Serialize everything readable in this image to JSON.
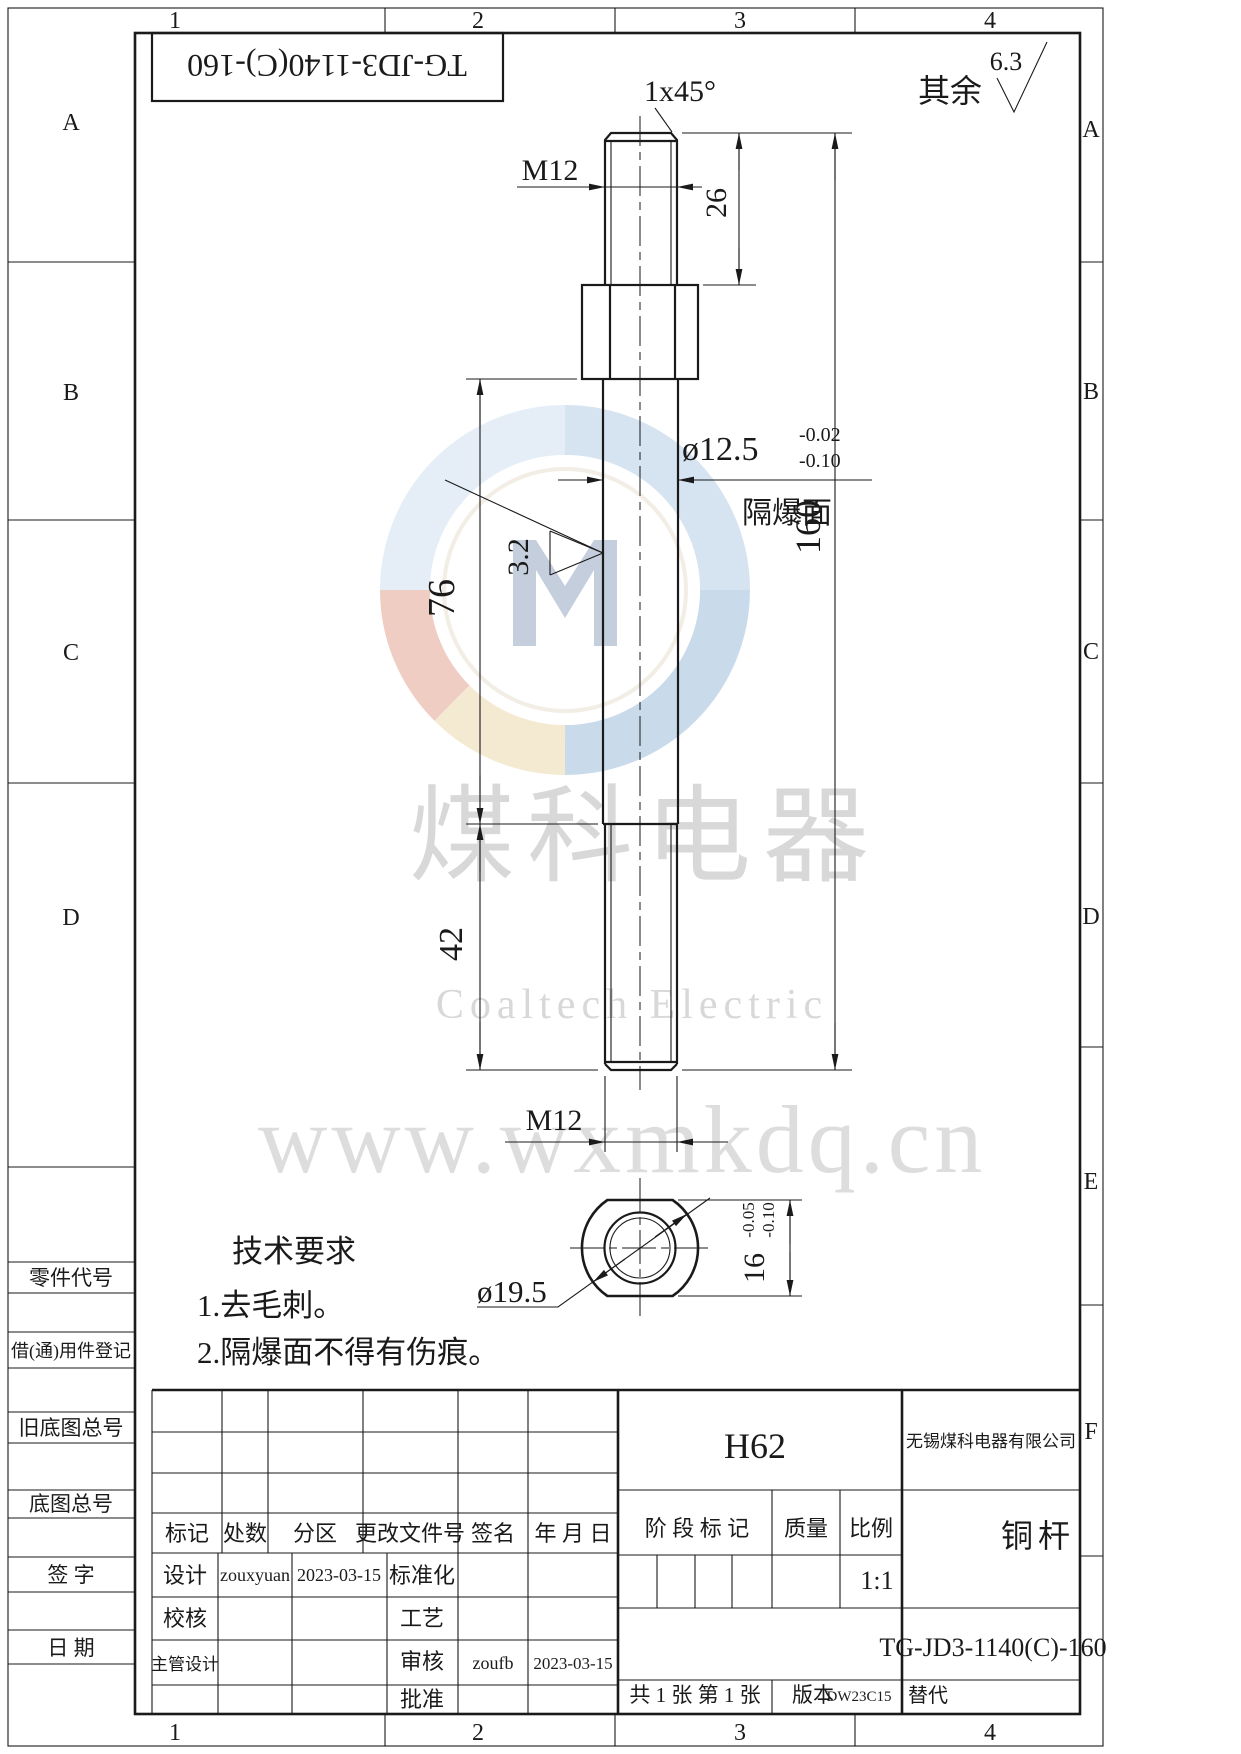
{
  "zones": {
    "top": [
      "1",
      "2",
      "3",
      "4"
    ],
    "bottom": [
      "1",
      "2",
      "3",
      "4"
    ],
    "left": [
      "A",
      "B",
      "C",
      "D"
    ],
    "right": [
      "A",
      "B",
      "C",
      "D",
      "E",
      "F"
    ]
  },
  "header": {
    "doc_no_flipped": "TG-JD3-1140(C)-160",
    "rest_label": "其余",
    "rest_roughness": "6.3"
  },
  "dims": {
    "chamfer": "1x45°",
    "m12_top": "M12",
    "len26": "26",
    "dia": "ø12.5",
    "dia_tol_hi": "-0.02",
    "dia_tol_lo": "-0.10",
    "flameproof": "隔爆面",
    "rough": "3.2",
    "len76": "76",
    "len160": "160",
    "len42": "42",
    "m12_bot": "M12",
    "dia_end": "ø19.5",
    "flats": "16",
    "flats_tol_hi": "-0.05",
    "flats_tol_lo": "-0.10"
  },
  "tech": {
    "title": "技术要求",
    "item1": "1.去毛刺。",
    "item2": "2.隔爆面不得有伤痕。"
  },
  "watermark": {
    "cn": "煤科电器",
    "en": "Coaltech Electric",
    "url": "www.wxmkdq.cn"
  },
  "margin": {
    "part_code": "零件代号",
    "borrow": "借(通)用件登记",
    "old_base": "旧底图总号",
    "base": "底图总号",
    "sign": "签 字",
    "date": "日 期"
  },
  "tb": {
    "rev_cols": [
      "标记",
      "处数",
      "分区",
      "更改文件号",
      "签名",
      "年 月 日"
    ],
    "design_label": "设计",
    "design_name": "zouxyuan",
    "design_date": "2023-03-15",
    "standard_label": "标准化",
    "check_label": "校核",
    "process_label": "工艺",
    "chief_label": "主管设计",
    "audit_label": "审核",
    "audit_name": "zoufb",
    "audit_date": "2023-03-15",
    "approve_label": "批准",
    "material": "H62",
    "company": "无锡煤科电器有限公司",
    "stage": "阶 段 标 记",
    "mass": "质量",
    "scale": "比例",
    "scale_value": "1:1",
    "part_name": "铜杆",
    "drawing_no": "TG-JD3-1140(C)-160",
    "sheets": "共 1 张  第 1 张",
    "version_label": "版本",
    "version_value": "DW23C15",
    "substitute_label": "替代"
  }
}
